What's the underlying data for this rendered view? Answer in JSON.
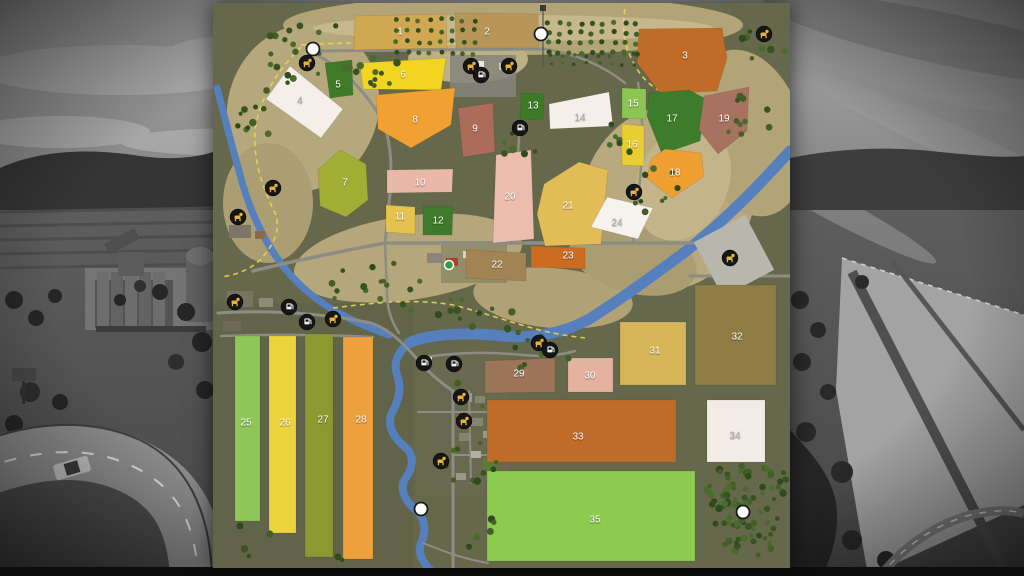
{
  "map": {
    "title": "farm-map-overlay",
    "palette": {
      "land": "#65684b",
      "land_dark": "#5d6045",
      "hill": "#b5a77c",
      "hill_light": "#c6b88c",
      "river": "#567fbe",
      "road": "#8d8d85",
      "road_minor": "#83837b",
      "path_yellow": "#ead54f",
      "icon_disc": "#161616",
      "icon_animal_glyph": "#e6b33c",
      "icon_service_glyph": "#efefef",
      "poi_white": "#ffffff",
      "start_green": "#2f9e3f",
      "tree_palette": [
        "#37531f",
        "#425f27",
        "#4a6b2d",
        "#2f4a1c"
      ],
      "label_white": "#ffffff",
      "label_on_white": "#beb6ae"
    },
    "terrain": [
      {
        "cx": 300,
        "cy": 22,
        "rx": 230,
        "ry": 30,
        "rot": 0,
        "fill": "#b3a478"
      },
      {
        "cx": 255,
        "cy": 56,
        "rx": 60,
        "ry": 24,
        "rot": 0,
        "fill": "#bdb085"
      },
      {
        "cx": 90,
        "cy": 105,
        "rx": 75,
        "ry": 85,
        "rot": 20,
        "fill": "#b6a87d"
      },
      {
        "cx": 55,
        "cy": 200,
        "rx": 45,
        "ry": 60,
        "rot": 0,
        "fill": "#ac9e73"
      },
      {
        "cx": 195,
        "cy": 255,
        "rx": 115,
        "ry": 42,
        "rot": -8,
        "fill": "#b5a77b"
      },
      {
        "cx": 340,
        "cy": 295,
        "rx": 80,
        "ry": 30,
        "rot": 5,
        "fill": "#b1a276"
      },
      {
        "cx": 455,
        "cy": 195,
        "rx": 85,
        "ry": 95,
        "rot": 25,
        "fill": "#b8aa7e"
      },
      {
        "cx": 535,
        "cy": 130,
        "rx": 55,
        "ry": 85,
        "rot": -15,
        "fill": "#b3a478"
      },
      {
        "cx": 420,
        "cy": 255,
        "rx": 65,
        "ry": 35,
        "rot": 15,
        "fill": "#ab9d72"
      },
      {
        "cx": 300,
        "cy": 25,
        "rx": 200,
        "ry": 13,
        "rot": 0,
        "fill": "#c6b88c"
      },
      {
        "cx": 470,
        "cy": 180,
        "rx": 45,
        "ry": 60,
        "rot": 25,
        "fill": "#c3b589"
      }
    ],
    "grounds": [
      {
        "x": 204,
        "y": 350,
        "w": 92,
        "h": 142,
        "fill": "#6a6b52",
        "op": 0.6
      },
      {
        "x": 228,
        "y": 238,
        "w": 66,
        "h": 42,
        "fill": "#6d6e55",
        "op": 0.45
      }
    ],
    "rivers": [
      {
        "d": "M4,85 C12,115 18,140 26,168 C34,200 46,228 62,252 C78,276 98,294 122,308 C140,318 158,326 176,332",
        "w": 7
      },
      {
        "d": "M577,148 C548,180 512,218 468,252 C438,274 408,296 378,315 C352,330 320,336 290,333 C252,329 215,331 196,340",
        "w": 11
      },
      {
        "d": "M196,340 C184,350 180,360 184,372 C190,388 184,400 178,412 C174,424 182,436 192,444 C202,452 200,466 192,476 C186,486 192,498 202,506 C212,514 214,528 208,540 C204,552 212,562 220,570",
        "w": 8
      }
    ],
    "yellow_paths": [
      {
        "d": "M88,44 C64,68 46,96 42,128 C40,158 50,186 62,210 C68,226 62,240 48,256 C38,266 24,272 8,274"
      },
      {
        "d": "M88,42 C150,38 210,40 260,42"
      },
      {
        "d": "M412,6 C408,28 412,46 424,66 C434,82 448,90 462,94"
      },
      {
        "d": "M120,305 C160,300 200,295 240,302 C280,312 310,324 340,330 C355,333 365,334 372,335"
      }
    ],
    "roads": [
      {
        "d": "M95,48 L332,46",
        "w": 3
      },
      {
        "d": "M95,48 C128,62 152,88 170,118 C178,140 180,165 176,200 L172,240",
        "w": 3
      },
      {
        "d": "M40,268 C80,258 130,248 172,240 L490,240",
        "w": 3.5
      },
      {
        "d": "M490,240 C505,246 515,252 522,260",
        "w": 2.5
      },
      {
        "d": "M5,310 C60,306 120,312 158,320 C176,326 190,340 204,356 C216,370 228,380 240,388",
        "w": 3
      },
      {
        "d": "M240,388 L240,565",
        "w": 3
      },
      {
        "d": "M205,409 L290,409",
        "w": 2
      },
      {
        "d": "M240,452 L285,452",
        "w": 2
      },
      {
        "d": "M256,388 L258,480",
        "w": 2
      },
      {
        "d": "M8,333 C60,331 120,332 160,334",
        "w": 2.5
      },
      {
        "d": "M477,273 L577,273",
        "w": 3
      },
      {
        "d": "M332,46 C360,50 390,62 412,80",
        "w": 2.5
      },
      {
        "d": "M425,80 C432,120 430,160 424,200 L420,240",
        "w": 2.5
      },
      {
        "d": "M307,120 C305,160 300,200 298,240",
        "w": 2.5
      },
      {
        "d": "M204,356 C230,350 270,348 310,352 C330,354 348,352 362,348",
        "w": 2.5
      },
      {
        "d": "M172,240 L174,290 C174,305 178,318 186,330",
        "w": 2.5
      },
      {
        "d": "M210,540 C230,548 250,556 275,560",
        "w": 2
      }
    ],
    "powerline": {
      "d": "M330,4 L330,64"
    },
    "buildings": [
      {
        "x": 237,
        "y": 52,
        "w": 66,
        "h": 42,
        "fill": "#85857d",
        "op": 0.85
      },
      {
        "x": 255,
        "y": 58,
        "w": 16,
        "h": 9,
        "fill": "#e8e8e2"
      },
      {
        "x": 286,
        "y": 60,
        "w": 10,
        "h": 7,
        "fill": "#c8c8c0"
      },
      {
        "x": 492,
        "y": 222,
        "w": 58,
        "h": 62,
        "fill": "#b7b7ae",
        "rot": -28
      },
      {
        "x": 214,
        "y": 250,
        "w": 16,
        "h": 10,
        "fill": "#8a8578"
      },
      {
        "x": 233,
        "y": 255,
        "w": 12,
        "h": 8,
        "fill": "#b04028"
      },
      {
        "x": 250,
        "y": 248,
        "w": 10,
        "h": 7,
        "fill": "#d8d5cc"
      },
      {
        "x": 262,
        "y": 252,
        "w": 16,
        "h": 11,
        "fill": "#e9e7df"
      },
      {
        "x": 16,
        "y": 222,
        "w": 22,
        "h": 13,
        "fill": "#7c7668"
      },
      {
        "x": 42,
        "y": 228,
        "w": 10,
        "h": 8,
        "fill": "#8a6a4a"
      },
      {
        "x": 14,
        "y": 288,
        "w": 26,
        "h": 16,
        "fill": "#79745f"
      },
      {
        "x": 46,
        "y": 295,
        "w": 14,
        "h": 9,
        "fill": "#8f8a7a"
      },
      {
        "x": 10,
        "y": 318,
        "w": 18,
        "h": 10,
        "fill": "#6f6a55"
      },
      {
        "x": 206,
        "y": 354,
        "w": 13,
        "h": 9,
        "fill": "#dcd9d0"
      },
      {
        "x": 247,
        "y": 390,
        "w": 12,
        "h": 9,
        "fill": "#9b978a"
      },
      {
        "x": 262,
        "y": 393,
        "w": 10,
        "h": 7,
        "fill": "#87836f"
      },
      {
        "x": 244,
        "y": 412,
        "w": 9,
        "h": 7,
        "fill": "#b3afa2"
      },
      {
        "x": 258,
        "y": 415,
        "w": 12,
        "h": 8,
        "fill": "#87836f"
      },
      {
        "x": 270,
        "y": 428,
        "w": 9,
        "h": 7,
        "fill": "#9b978a"
      },
      {
        "x": 246,
        "y": 430,
        "w": 10,
        "h": 8,
        "fill": "#87836f"
      },
      {
        "x": 258,
        "y": 448,
        "w": 10,
        "h": 7,
        "fill": "#b3afa2"
      },
      {
        "x": 270,
        "y": 455,
        "w": 14,
        "h": 16,
        "fill": "#5d7a3d"
      },
      {
        "x": 243,
        "y": 470,
        "w": 10,
        "h": 7,
        "fill": "#9b978a"
      }
    ],
    "fields": [
      {
        "id": 1,
        "label": "1",
        "color": "#d0a851",
        "points": "142,13 233,11 234,45 141,47",
        "label_pos": [
          187,
          28
        ]
      },
      {
        "id": 2,
        "label": "2",
        "color": "#b79657",
        "points": "242,10 325,11 326,45 243,45",
        "label_pos": [
          274,
          28
        ]
      },
      {
        "id": 3,
        "label": "3",
        "color": "#c06b28",
        "points": "426,26 509,25 514,55 504,88 448,91 424,60",
        "label_pos": [
          472,
          52
        ]
      },
      {
        "id": 4,
        "label": "4",
        "color": "#f4efe9",
        "points": "77,63 130,106 108,135 53,96",
        "label_pos": [
          87,
          97
        ],
        "on_white": true
      },
      {
        "id": 5,
        "label": "5",
        "color": "#3e7a27",
        "points": "112,60 139,57 140,92 117,95",
        "label_pos": [
          125,
          81
        ]
      },
      {
        "id": 6,
        "label": "6",
        "color": "#f1d521",
        "points": "147,60 233,55 228,87 150,86",
        "label_pos": [
          190,
          71
        ]
      },
      {
        "id": 7,
        "label": "7",
        "color": "#a2ad33",
        "points": "127,147 105,167 107,203 133,214 155,197 153,161",
        "label_pos": [
          132,
          179
        ]
      },
      {
        "id": 8,
        "label": "8",
        "color": "#f0a132",
        "points": "163,92 242,85 238,122 198,145 165,126",
        "label_pos": [
          202,
          116
        ]
      },
      {
        "id": 9,
        "label": "9",
        "color": "#ac6c59",
        "points": "245,105 280,100 282,149 250,154",
        "label_pos": [
          262,
          125
        ]
      },
      {
        "id": 10,
        "label": "10",
        "color": "#e9b8a9",
        "points": "174,167 240,166 239,189 174,190",
        "label_pos": [
          207,
          179
        ]
      },
      {
        "id": 11,
        "label": "11",
        "color": "#e5c34e",
        "points": "173,202 202,204 202,231 173,229",
        "label_pos": [
          187,
          213
        ]
      },
      {
        "id": 12,
        "label": "12",
        "color": "#3e7a2a",
        "points": "210,203 240,203 239,232 210,232",
        "label_pos": [
          225,
          217
        ]
      },
      {
        "id": 13,
        "label": "13",
        "color": "#3c7a28",
        "points": "308,90 331,91 330,117 307,116",
        "label_pos": [
          320,
          102
        ]
      },
      {
        "id": 14,
        "label": "14",
        "color": "#f5efe9",
        "points": "336,101 396,89 400,123 337,126",
        "label_pos": [
          367,
          114
        ],
        "on_white": true
      },
      {
        "id": 15,
        "label": "15",
        "color": "#8cc553",
        "points": "409,85 433,86 433,116 409,115",
        "label_pos": [
          420,
          100
        ]
      },
      {
        "id": 16,
        "label": "16",
        "color": "#e9cd33",
        "points": "409,121 431,123 431,163 409,162",
        "label_pos": [
          419,
          141
        ]
      },
      {
        "id": 17,
        "label": "17",
        "color": "#3d7c2a",
        "points": "436,90 476,87 493,96 487,138 449,151 434,113",
        "label_pos": [
          459,
          115
        ]
      },
      {
        "id": 18,
        "label": "18",
        "color": "#f0a030",
        "points": "452,146 488,150 491,173 459,195 434,175 438,156",
        "label_pos": [
          462,
          169
        ]
      },
      {
        "id": 19,
        "label": "19",
        "color": "#a87260",
        "points": "491,93 536,84 534,128 505,151 486,127",
        "label_pos": [
          511,
          115
        ]
      },
      {
        "id": 20,
        "label": "20",
        "color": "#ecbcae",
        "points": "283,152 318,147 321,236 280,240",
        "label_pos": [
          297,
          193
        ]
      },
      {
        "id": 21,
        "label": "21",
        "color": "#e2bd57",
        "points": "331,181 366,159 395,167 388,241 332,243 324,211",
        "label_pos": [
          355,
          202
        ]
      },
      {
        "id": 22,
        "label": "22",
        "color": "#a28353",
        "points": "253,247 313,250 313,278 253,275",
        "label_pos": [
          284,
          261
        ]
      },
      {
        "id": 23,
        "label": "23",
        "color": "#cc6c20",
        "points": "318,243 372,245 372,266 318,264",
        "label_pos": [
          355,
          252
        ]
      },
      {
        "id": 24,
        "label": "24",
        "color": "#f6f2ee",
        "points": "394,194 440,205 425,236 378,224",
        "label_pos": [
          404,
          219
        ],
        "on_white": true
      },
      {
        "id": 25,
        "label": "25",
        "color": "#8fc658",
        "points": "22,333 47,333 47,518 22,518",
        "label_pos": [
          33,
          419
        ]
      },
      {
        "id": 26,
        "label": "26",
        "color": "#ecd23c",
        "points": "56,333 83,333 83,530 56,530",
        "label_pos": [
          72,
          419
        ]
      },
      {
        "id": 27,
        "label": "27",
        "color": "#8a9a30",
        "points": "92,331 120,331 120,554 92,554",
        "label_pos": [
          110,
          416
        ]
      },
      {
        "id": 28,
        "label": "28",
        "color": "#eda03c",
        "points": "130,334 160,334 160,556 130,556",
        "label_pos": [
          148,
          416
        ]
      },
      {
        "id": 29,
        "label": "29",
        "color": "#9c7458",
        "points": "272,358 342,355 342,389 272,390",
        "label_pos": [
          306,
          370
        ]
      },
      {
        "id": 30,
        "label": "30",
        "color": "#e5b2a2",
        "points": "355,355 400,355 400,389 355,389",
        "label_pos": [
          377,
          372
        ]
      },
      {
        "id": 31,
        "label": "31",
        "color": "#d5b557",
        "points": "407,319 473,319 473,382 407,382",
        "label_pos": [
          442,
          347
        ]
      },
      {
        "id": 32,
        "label": "32",
        "color": "#8f7d44",
        "points": "482,282 563,282 563,382 482,382",
        "label_pos": [
          524,
          333
        ]
      },
      {
        "id": 33,
        "label": "33",
        "color": "#bf6c28",
        "points": "274,397 463,397 463,459 274,459",
        "label_pos": [
          365,
          433
        ]
      },
      {
        "id": 34,
        "label": "34",
        "color": "#f3ece6",
        "points": "494,397 552,397 552,459 494,459",
        "label_pos": [
          522,
          432
        ],
        "on_white": true
      },
      {
        "id": 35,
        "label": "35",
        "color": "#8ccb50",
        "points": "274,468 482,468 482,558 274,558",
        "label_pos": [
          382,
          516
        ]
      }
    ],
    "orchards": [
      {
        "x": 184,
        "y": 17,
        "cols": 8,
        "rows": 4,
        "dx": 11,
        "dy": 11,
        "r": 2.4
      },
      {
        "x": 335,
        "y": 20,
        "cols": 9,
        "rows": 4,
        "dx": 11,
        "dy": 10,
        "r": 2.6
      },
      {
        "x": 338,
        "y": 52,
        "cols": 8,
        "rows": 2,
        "dx": 12,
        "dy": 9,
        "r": 1.8
      }
    ],
    "tree_clusters": [
      {
        "x": 55,
        "y": 20,
        "w": 70,
        "h": 60,
        "n": 18,
        "seed": 11
      },
      {
        "x": 18,
        "y": 85,
        "w": 40,
        "h": 70,
        "n": 10,
        "seed": 12
      },
      {
        "x": 130,
        "y": 55,
        "w": 55,
        "h": 30,
        "n": 8,
        "seed": 13
      },
      {
        "x": 95,
        "y": 255,
        "w": 120,
        "h": 60,
        "n": 16,
        "seed": 14
      },
      {
        "x": 225,
        "y": 290,
        "w": 90,
        "h": 40,
        "n": 12,
        "seed": 15
      },
      {
        "x": 420,
        "y": 165,
        "w": 50,
        "h": 60,
        "n": 9,
        "seed": 16
      },
      {
        "x": 515,
        "y": 90,
        "w": 55,
        "h": 50,
        "n": 10,
        "seed": 17
      },
      {
        "x": 528,
        "y": 28,
        "w": 45,
        "h": 30,
        "n": 8,
        "seed": 18
      },
      {
        "x": 230,
        "y": 380,
        "w": 60,
        "h": 100,
        "n": 10,
        "seed": 19
      },
      {
        "x": 250,
        "y": 470,
        "w": 40,
        "h": 80,
        "n": 7,
        "seed": 20
      },
      {
        "x": 300,
        "y": 330,
        "w": 60,
        "h": 40,
        "n": 8,
        "seed": 21
      },
      {
        "x": 20,
        "y": 520,
        "w": 150,
        "h": 40,
        "n": 6,
        "seed": 22
      },
      {
        "x": 155,
        "y": 60,
        "w": 30,
        "h": 25,
        "n": 5,
        "seed": 23
      },
      {
        "x": 395,
        "y": 120,
        "w": 30,
        "h": 30,
        "n": 6,
        "seed": 24
      },
      {
        "x": 290,
        "y": 130,
        "w": 40,
        "h": 30,
        "n": 6,
        "seed": 25
      },
      {
        "x": 493,
        "y": 463,
        "w": 82,
        "h": 38,
        "n": 42,
        "seed": 26
      },
      {
        "x": 499,
        "y": 498,
        "w": 66,
        "h": 30,
        "n": 30,
        "seed": 27
      },
      {
        "x": 510,
        "y": 528,
        "w": 48,
        "h": 24,
        "n": 16,
        "seed": 28
      }
    ],
    "icons": [
      {
        "type": "animal",
        "x": 94,
        "y": 60
      },
      {
        "type": "animal",
        "x": 258,
        "y": 63
      },
      {
        "type": "animal",
        "x": 296,
        "y": 63
      },
      {
        "type": "animal",
        "x": 551,
        "y": 31
      },
      {
        "type": "animal",
        "x": 421,
        "y": 189
      },
      {
        "type": "animal",
        "x": 60,
        "y": 185
      },
      {
        "type": "animal",
        "x": 25,
        "y": 214
      },
      {
        "type": "animal",
        "x": 22,
        "y": 299
      },
      {
        "type": "animal",
        "x": 120,
        "y": 316
      },
      {
        "type": "animal",
        "x": 517,
        "y": 255
      },
      {
        "type": "animal",
        "x": 326,
        "y": 340
      },
      {
        "type": "animal",
        "x": 248,
        "y": 394
      },
      {
        "type": "animal",
        "x": 251,
        "y": 418
      },
      {
        "type": "animal",
        "x": 228,
        "y": 458
      },
      {
        "type": "service",
        "x": 268,
        "y": 72
      },
      {
        "type": "service",
        "x": 307,
        "y": 125
      },
      {
        "type": "service",
        "x": 76,
        "y": 304
      },
      {
        "type": "service",
        "x": 94,
        "y": 319
      },
      {
        "type": "service",
        "x": 211,
        "y": 360
      },
      {
        "type": "service",
        "x": 241,
        "y": 361
      },
      {
        "type": "service",
        "x": 337,
        "y": 347
      },
      {
        "type": "poi",
        "x": 100,
        "y": 46
      },
      {
        "type": "poi",
        "x": 328,
        "y": 31
      },
      {
        "type": "poi",
        "x": 208,
        "y": 506
      },
      {
        "type": "poi",
        "x": 530,
        "y": 509
      },
      {
        "type": "start",
        "x": 236,
        "y": 262
      }
    ]
  },
  "background": {
    "style": "grayscale-game-scene",
    "sky": "#a8a8a8",
    "hills": "#373737",
    "road": "#8a8a8a",
    "vignette": "rgba(0,0,0,0.6)"
  }
}
